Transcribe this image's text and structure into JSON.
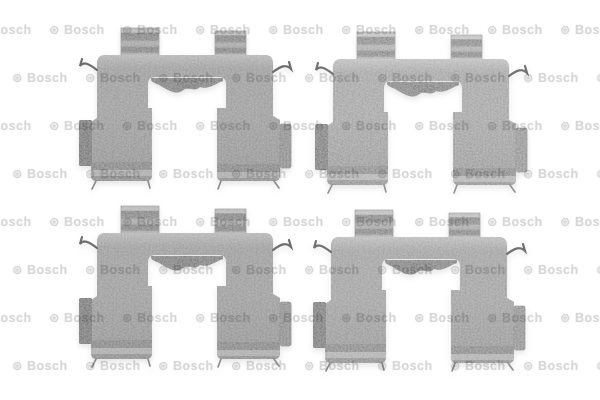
{
  "image": {
    "alt": "Four steel disc-brake pad fitting clips (accessory kit) arranged in two rows of two on a white background with a repeating Bosch watermark",
    "background_color": "#ffffff"
  },
  "watermark": {
    "symbol_char": "⊛",
    "text": "Bosch",
    "color": "#d5d5d5",
    "font_size_px": 12.5,
    "grid": {
      "rows": 8,
      "cols": 10,
      "row_start_y": 30,
      "row_step": 48,
      "col_start_x": -24,
      "col_step": 73,
      "stagger_x": 36
    }
  },
  "clips": {
    "part_name": "brake-pad-fitting-clip",
    "count": 4,
    "colors": {
      "metal": "#8d8d8d",
      "metal_shadow": "#6f6f6f",
      "left_block": "#3c3c3c",
      "right_block": "#757575",
      "shim": "#4a4a4a",
      "fold_dark": "#5f5f5f",
      "fold_light": "#b5b5b5",
      "hook": "#6d6d6d",
      "wire": "#8a8a8a"
    },
    "instances": [
      {
        "id": "clip-top-left",
        "x": 76,
        "y": 20,
        "brightness": 1.0
      },
      {
        "id": "clip-top-right",
        "x": 312,
        "y": 24,
        "brightness": 1.05
      },
      {
        "id": "clip-bottom-left",
        "x": 76,
        "y": 198,
        "brightness": 1.0
      },
      {
        "id": "clip-bottom-right",
        "x": 310,
        "y": 202,
        "brightness": 1.03
      }
    ]
  }
}
